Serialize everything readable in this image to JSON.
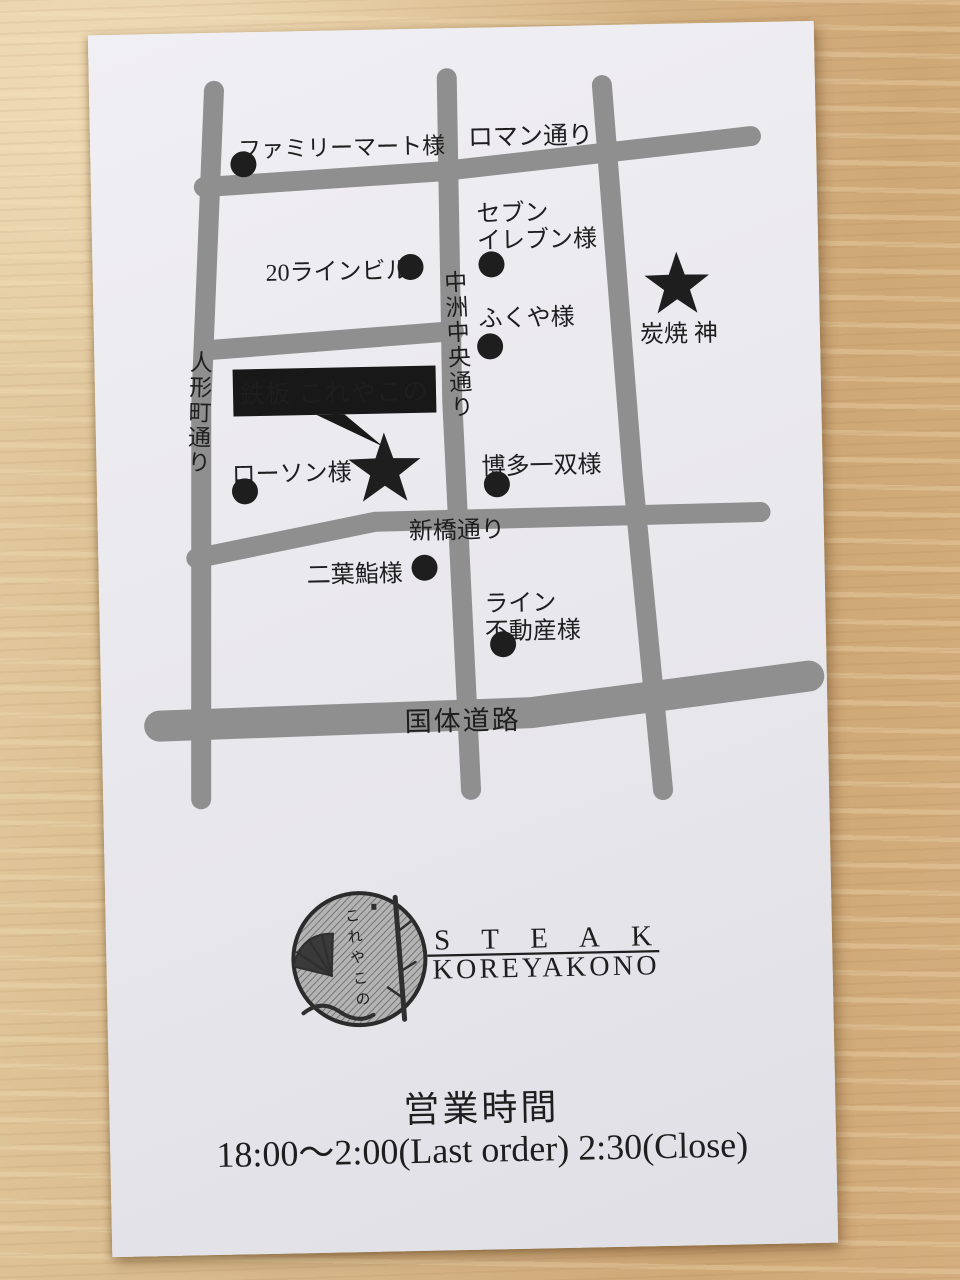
{
  "map": {
    "streets": {
      "ningyocho": "人形町通り",
      "nakasu_chuo": "中洲中央通り",
      "roman": "ロマン通り",
      "shinbashi": "新橋通り",
      "kokutai": "国体道路"
    },
    "landmarks": {
      "familymart": "ファミリーマート様",
      "line20_building": "20ラインビル",
      "seven_line1": "セブン",
      "seven_line2": "イレブン様",
      "fukuya": "ふくや様",
      "sumiyaki_jin": "炭焼 神",
      "lawson": "ローソン様",
      "hakata_issou": "博多一双様",
      "futaba_sushi": "二葉鮨様",
      "line_fudosan_line1": "ライン",
      "line_fudosan_line2": "不動産様"
    },
    "destination_label": "鉄板 これやこの"
  },
  "logo": {
    "stamp_text": "これやこの",
    "name_en": "STEAK",
    "name_romaji": "KOREYAKONO"
  },
  "hours": {
    "heading": "営業時間",
    "schedule": "18:00〜2:00(Last order) 2:30(Close)"
  },
  "colors": {
    "ink": "#1e1e1e",
    "street_gray": "#8f8f8f",
    "card_white": "#e9e9ed",
    "wood_tan": "#d6b98c"
  }
}
